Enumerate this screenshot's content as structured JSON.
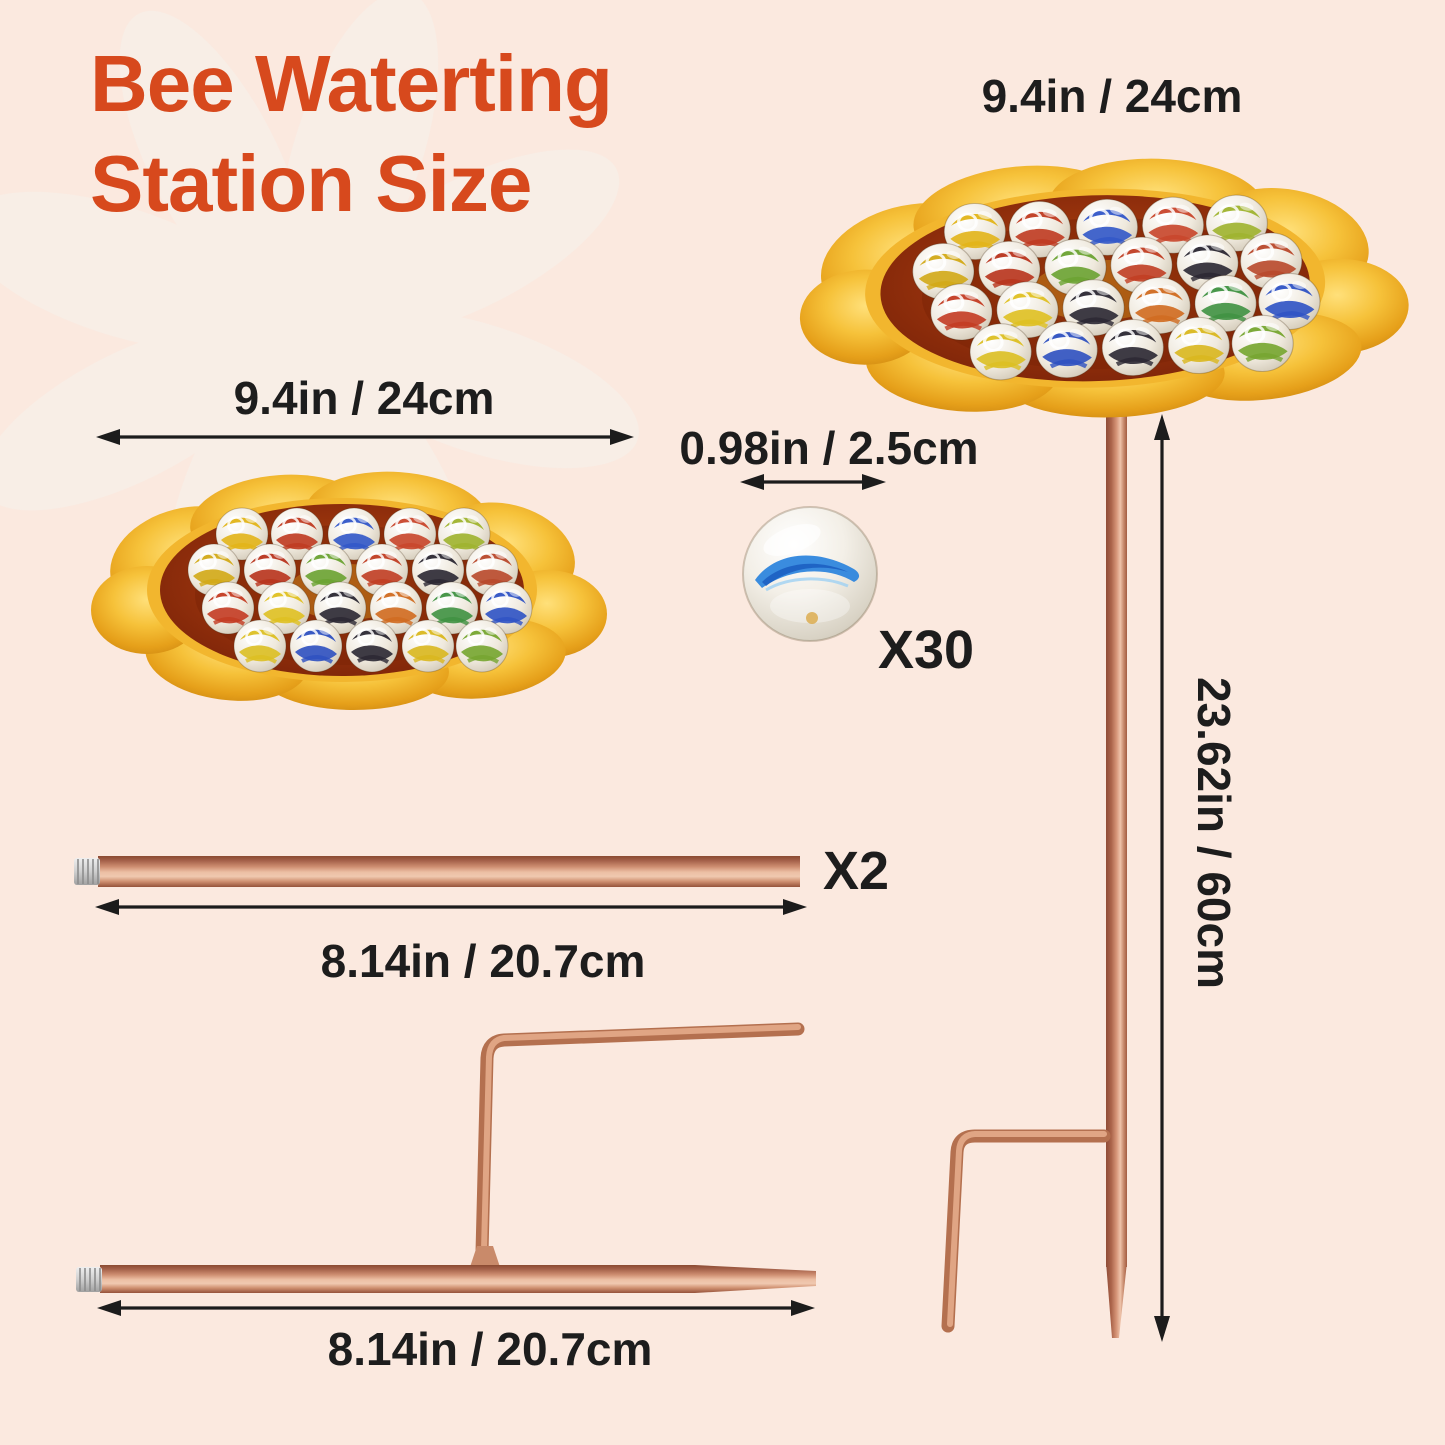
{
  "page": {
    "background_color": "#fbe9df",
    "accent_color": "#d7491d",
    "text_color": "#1d1d1d"
  },
  "title": {
    "line1": "Bee Waterting",
    "line2": "Station Size"
  },
  "dimensions": {
    "top_dish": "9.4in / 24cm",
    "left_dish": "9.4in / 24cm",
    "marble": "0.98in / 2.5cm",
    "stake_height": "23.62in / 60cm",
    "extension_rod": "8.14in / 20.7cm",
    "ground_rod": "8.14in / 20.7cm"
  },
  "counts": {
    "marbles": "X30",
    "rods": "X2"
  },
  "icons": {
    "watermark": "flower-watermark-icon"
  },
  "colors": {
    "dish_gold": "#f6c23a",
    "dish_pool": "#8c2d0e",
    "copper": "#c98a6a",
    "marble_blue_swirl": "#2f86dd",
    "arrow_black": "#1c1c1c"
  }
}
